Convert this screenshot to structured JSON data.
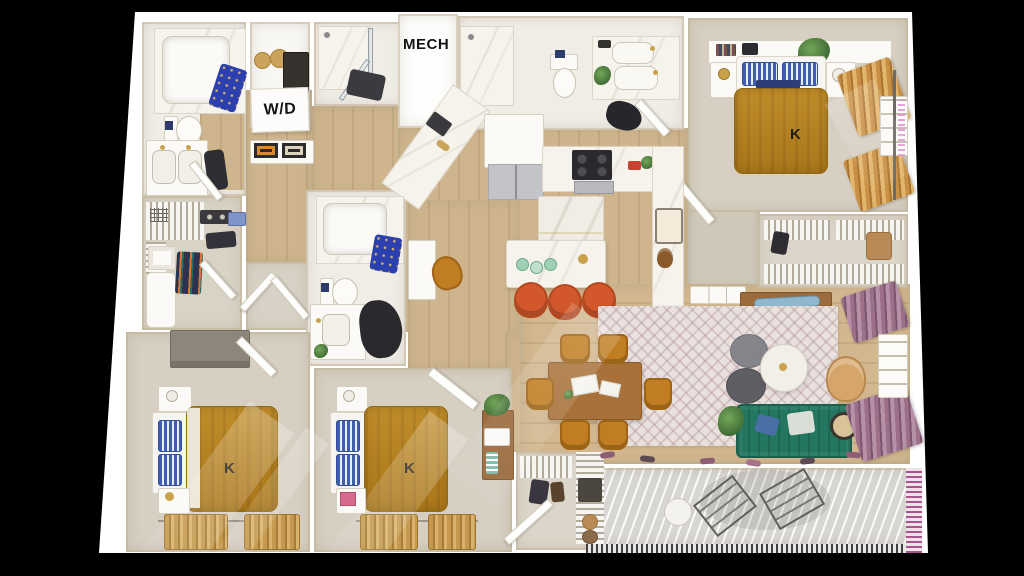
{
  "scene": {
    "type": "3d-apartment-floorplan-render",
    "background": "#000000"
  },
  "labels": {
    "mech": "MECH",
    "washer_dryer": "W/D",
    "king": "K"
  },
  "palette": {
    "plan_white": "#ffffff",
    "wall_face_beige": "#cfc8ba",
    "wood_floor": "#cfb58d",
    "bedroom_carpet": "#d6cfc2",
    "bath_floor": "#f0ede7",
    "bed_blanket_mustard": "#b5821f",
    "pillow_blue": "#3f5fae",
    "shower_curtain_blue": "#2b3fae",
    "stool_orange": "#d2582c",
    "dining_chair_amber": "#c07d22",
    "sofa_green": "#237660",
    "living_rug": "#e9e1dd",
    "curtain_gold": "#c99045",
    "curtain_mauve": "#9b7088",
    "balcony_deck": "#d7d6d3",
    "balcony_rail_purple": "#a9548a",
    "dining_table_wood": "#a8713a"
  }
}
